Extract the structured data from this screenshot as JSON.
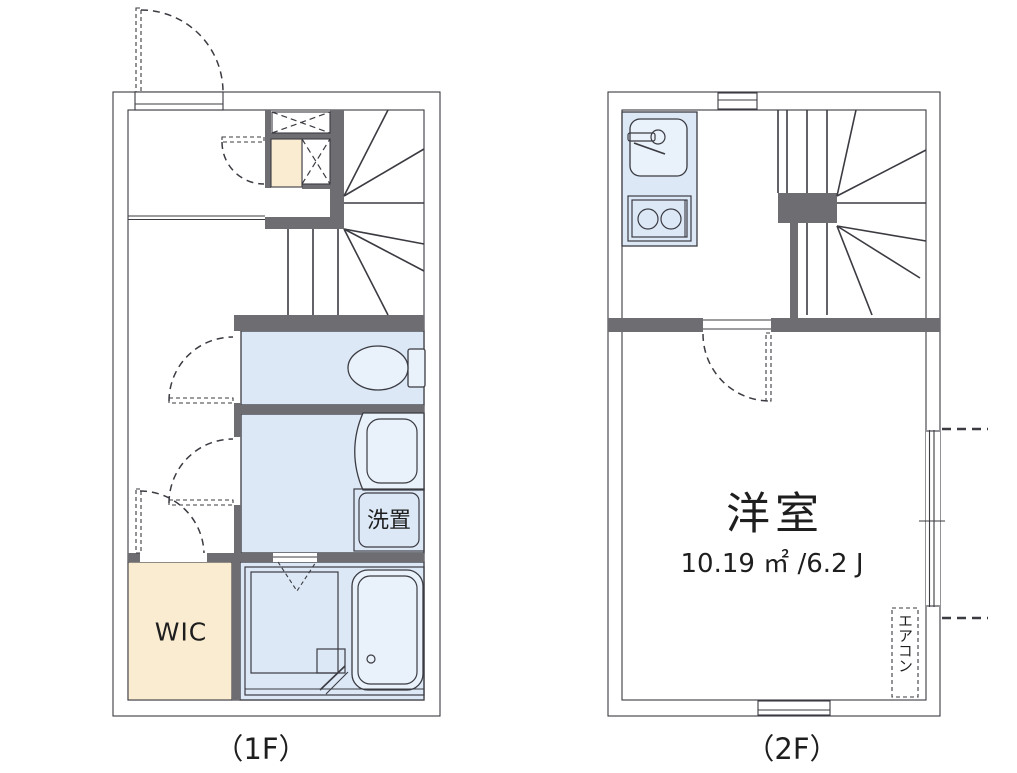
{
  "drawing": {
    "type": "apartment-floor-plan",
    "floors": [
      "1F",
      "2F"
    ]
  },
  "labels": {
    "floor1": "（1F）",
    "floor2": "（2F）",
    "wic": "WIC",
    "laundry": "洗置",
    "western_room": "洋室",
    "western_room_area": "10.19 ㎡ /6.2 J",
    "aircon": "エアコン"
  },
  "colors": {
    "wall": "#6d6d72",
    "room_blue": "#dce8f6",
    "fixture_blue": "#e9f1fa",
    "wic_cream": "#faecd0",
    "line": "#3b3b42",
    "text": "#1e1e1e"
  }
}
